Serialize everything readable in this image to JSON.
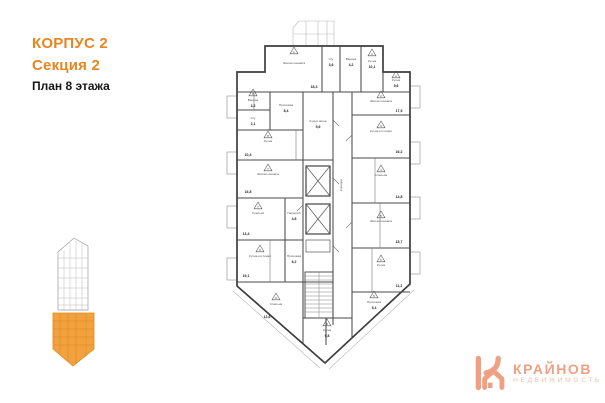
{
  "header": {
    "building": "КОРПУС 2",
    "section": "Секция 2",
    "plan": "План 8 этажа",
    "accent_color": "#E8851F",
    "text_color": "#161616"
  },
  "logo": {
    "brand": "КРАЙНОВ",
    "tagline": "НЕДВИЖИМОСТЬ",
    "brand_color": "#EFA083",
    "tagline_color": "#F3C2A5"
  },
  "minimap": {
    "highlight_color": "#F2A13F",
    "highlighted_section": "Секция 2"
  },
  "plan": {
    "wall_color": "#3d3d3d",
    "rooms": [
      {
        "label": "Жилая комната",
        "area": "18,3"
      },
      {
        "label": "С/у",
        "area": "3,6"
      },
      {
        "label": "Ванная",
        "area": "4,2"
      },
      {
        "label": "Кухня",
        "area": "10,1"
      },
      {
        "label": "Кухня",
        "area": "9,6"
      },
      {
        "label": "Жилая комната",
        "area": "17,5"
      },
      {
        "label": "Кухня-гостиная",
        "area": "16,2"
      },
      {
        "label": "Спальня",
        "area": "14,8"
      },
      {
        "label": "Жилая комната",
        "area": "15,7"
      },
      {
        "label": "Кухня",
        "area": "11,2"
      },
      {
        "label": "Ванная",
        "area": "3,2"
      },
      {
        "label": "С/у",
        "area": "2,1"
      },
      {
        "label": "Прихожая",
        "area": "8,4"
      },
      {
        "label": "Кухня",
        "area": "10,4"
      },
      {
        "label": "Жилая комната",
        "area": "16,8"
      },
      {
        "label": "Спальня",
        "area": "13,4"
      },
      {
        "label": "Гардероб",
        "area": "4,8"
      },
      {
        "label": "Кухня-гостиная",
        "area": "19,1"
      },
      {
        "label": "Прихожая",
        "area": "6,2"
      },
      {
        "label": "Спальня",
        "area": "12,6"
      },
      {
        "label": "Кухня",
        "area": "9,8"
      },
      {
        "label": "Прихожая",
        "area": "5,4"
      },
      {
        "label": "Кухня-ниша",
        "area": "5,6"
      },
      {
        "label": "Коридор"
      }
    ],
    "markers": [
      "1",
      "1",
      "2",
      "2",
      "3",
      "4",
      "5",
      "6",
      "8",
      "8",
      "7",
      "7",
      "6",
      "9",
      "9",
      "5"
    ]
  }
}
